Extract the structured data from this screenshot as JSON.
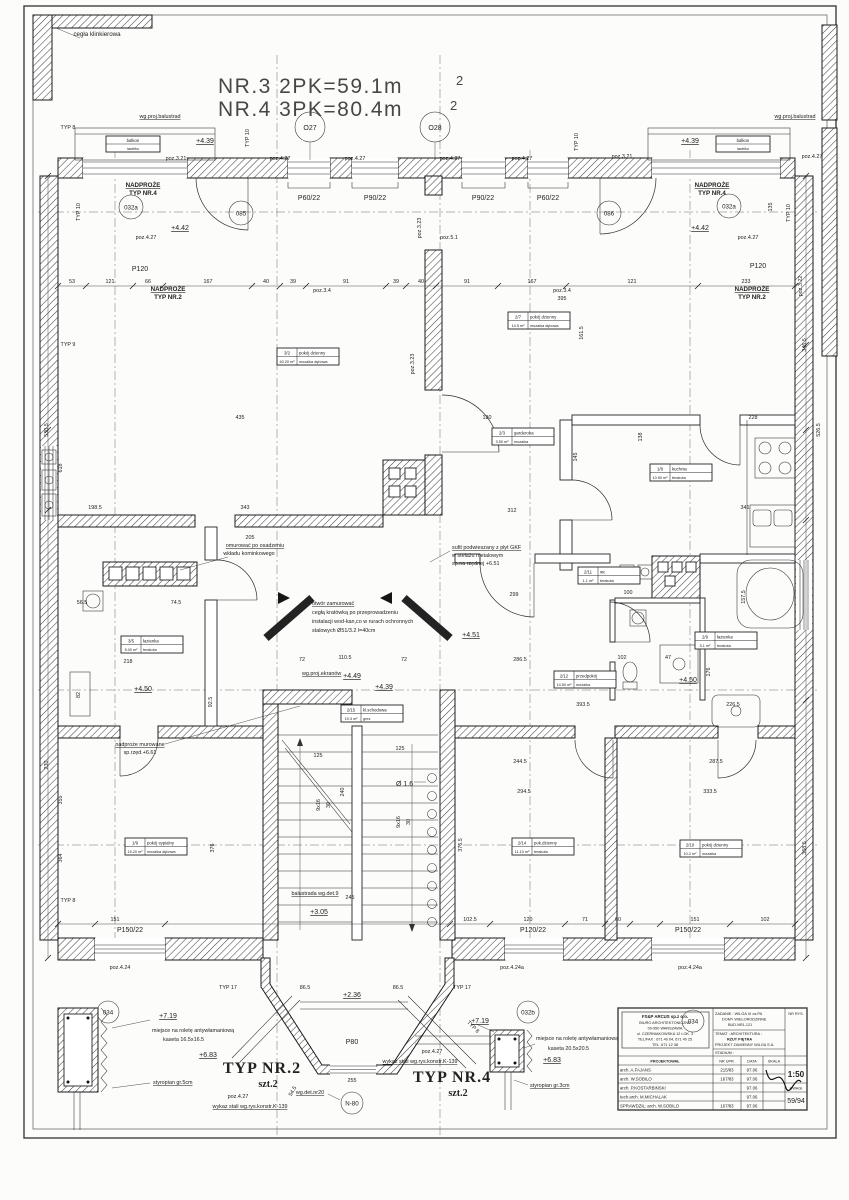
{
  "title": {
    "l1": "NR.3 2PK=59.1m",
    "s1": "2",
    "l2": "NR.4 3PK=80.4m",
    "s2": "2"
  },
  "mk": {
    "o27": "O27",
    "o28": "O28",
    "o85": "085",
    "o86": "086",
    "o32a": "032a",
    "o32b": "032b",
    "o34": "034",
    "n80": "N-80"
  },
  "win": {
    "p60": "P60/22",
    "p90": "P90/22",
    "p120": "P120",
    "p150": "P150/22",
    "p12022": "P120/22",
    "p80": "P80"
  },
  "poz": {
    "p427": "poz.4.27",
    "p321": "poz.3.21",
    "p322": "poz.3.22",
    "p323": "poz.3.23",
    "p34": "poz.3.4",
    "p51": "poz.5.1",
    "p424": "poz.4.24",
    "p424a": "poz.4.24a"
  },
  "lvl": {
    "v439": "+4.39",
    "v442": "+4.42",
    "v449": "+4.49",
    "v450": "+4.50",
    "v451": "+4.51",
    "v305": "+3.05",
    "v236": "+2.36",
    "v719": "+7.19",
    "v683": "+6.83"
  },
  "typ": {
    "t8": "TYP 8",
    "t9": "TYP 9",
    "t10": "TYP 10",
    "t17": "TYP 17"
  },
  "nad": {
    "l1": "NADPROŻE",
    "nr4": "TYP NR.4",
    "nr2": "TYP NR.2"
  },
  "notes": {
    "klinkier": "cegła klinkierowa",
    "balustrad": "wg.proj.balustrad",
    "komin1": "omurować po osadzeniu",
    "komin2": "wkładu kominkowego",
    "sufit1": "sufit podwieszany z płyt GKF",
    "sufit2": "w stelażu metalowym",
    "sufit3": "sp.na rzędnej +6.51",
    "otwor1": "otwór zamurować",
    "otwor2": "cegłą kratówką po przeprowadzeniu",
    "otwor3": "instalacji wod-kan,co w rurach ochronnych",
    "otwor4": "stalowych Ø51/3.2 l=40cm",
    "ekrany": "wg.proj.ekranów",
    "nadmur1": "nadproże murowane",
    "nadmur2": "sp.rzęd.+6.61",
    "balustrada9": "balustrada wg.det.9",
    "det20": "wg.det.nr20",
    "fi16": "Ø 1.6"
  },
  "rooms": [
    {
      "num": "3/2",
      "name": "pokój dzienny",
      "area": "40.20 m²",
      "floor": "mozaika dębowa"
    },
    {
      "num": "2/7",
      "name": "pokój dzienny",
      "area": "14.5 m²",
      "floor": "mozaika dębowa"
    },
    {
      "num": "2/3",
      "name": "garderoba",
      "area": "3.50 m²",
      "floor": "mozaika"
    },
    {
      "num": "1/8",
      "name": "kuchnia",
      "area": "10.50 m²",
      "floor": "terakota"
    },
    {
      "num": "2/11",
      "name": "wc",
      "area": "1.1 m²",
      "floor": "terakota"
    },
    {
      "num": "2/9",
      "name": "łazienka",
      "area": "5.1 m²",
      "floor": "terakota"
    },
    {
      "num": "3/5",
      "name": "łazienka",
      "area": "5.00 m²",
      "floor": "terakota"
    },
    {
      "num": "2/12",
      "name": "przedpokój",
      "area": "14.50 m²",
      "floor": "mozaika"
    },
    {
      "num": "2/15",
      "name": "kl.schodowa",
      "area": "19.3 m²",
      "floor": "gres"
    },
    {
      "num": "1/9",
      "name": "pokój sypialny",
      "area": "15.20 m²",
      "floor": "mozaika dębowa"
    },
    {
      "num": "2/14",
      "name": "pok.dzienny",
      "area": "11.10 m²",
      "floor": "terakota"
    },
    {
      "num": "2/10",
      "name": "pokój dzienny",
      "area": "10.2 m²",
      "floor": "mozaika"
    }
  ],
  "balcony": {
    "name": "balkon",
    "floor": "lastriko"
  },
  "details": {
    "left": {
      "title": "TYP NR.2",
      "qty": "szt.2",
      "roleta": "miejsce na roletę antywłamaniową",
      "kaseta": "kaseta 16.5x16.5",
      "styro": "styropian gr.5cm",
      "steel": "wykaz stali wg.rys.konstr.K-139"
    },
    "right": {
      "title": "TYP NR.4",
      "qty": "szt.2",
      "roleta": "miejsce na roletę antywłamaniową",
      "kaseta": "kaseta 20.5x20.5",
      "styro": "styropian gr.3cm",
      "steel": "wykaz stali wg.rys.konstr.K-139"
    }
  },
  "titleblock": {
    "company": [
      "FS&P ARCUS sp.z o.o.",
      "BIURO ARCHITEKTONICZNE",
      "00-950 WARSZAWA",
      "ul. CZERNIAKOWSKA 12 LOK. 3",
      "TEL/FAX : 671 40 04, 671 40 25",
      "TEL. 671 12 38"
    ],
    "zadanie1": "ZADANIE : WILGA VI os.PA",
    "zadanie2": "DOMY WIELORODZINNE",
    "zadanie3": "BUD.NR1-121",
    "temat1": "TEMAT : ARCHITEKTURA :",
    "temat2": "RZUT PIĘTRA",
    "temat3": "PROJEKT ZAMIENNY WILGA S.A.",
    "stadium": "STADIUM :",
    "nr_rys": "NR RYS.",
    "h_proj": "PROJEKTOWAŁ",
    "h_upr": "NR UPR.",
    "h_data": "DATA",
    "h_podpis": "PODPIS",
    "h_skala": "SKALA",
    "h_uwagi": "UWAGI",
    "skala": "1:50",
    "nr": "59/94",
    "rows": [
      {
        "n": "arch. A.FAJANS",
        "u": "215/83",
        "d": "97.06"
      },
      {
        "n": "arch. W.SOBILO",
        "u": "167/83",
        "d": "97.06"
      },
      {
        "n": "arch. P.KOSTARBIŃSKI",
        "u": "",
        "d": "97.06"
      },
      {
        "n": "tech.arch. M.MICHALAK",
        "u": "",
        "d": "97.06"
      },
      {
        "n": "SPRAWDZIŁ: arch. W.SOBILO",
        "u": "167/83",
        "d": "97.06"
      }
    ]
  },
  "dims": [
    "53",
    "121",
    "66",
    "167",
    "40",
    "39",
    "91",
    "39",
    "40",
    "91",
    "167",
    "121",
    "233",
    "395",
    "530.5",
    "618",
    "198.5",
    "343",
    "205",
    "435",
    "180",
    "312",
    "341",
    "228",
    "299",
    "286.5",
    "110.5",
    "72",
    "72",
    "393.5",
    "244.5",
    "294.5",
    "287.5",
    "333.5",
    "376.5",
    "368.5",
    "346.5",
    "526.5",
    "161.5",
    "135",
    "145",
    "138",
    "102.5",
    "120",
    "71",
    "60",
    "151",
    "102",
    "151",
    "230",
    "355",
    "364",
    "376",
    "245",
    "255",
    "86.5",
    "86.5",
    "74.5",
    "56.5",
    "218",
    "100",
    "102",
    "47",
    "176",
    "157.5",
    "82",
    "92.5",
    "9x16",
    "30",
    "240",
    "9x16",
    "30",
    "125",
    "125",
    "54.5",
    "226.5"
  ]
}
